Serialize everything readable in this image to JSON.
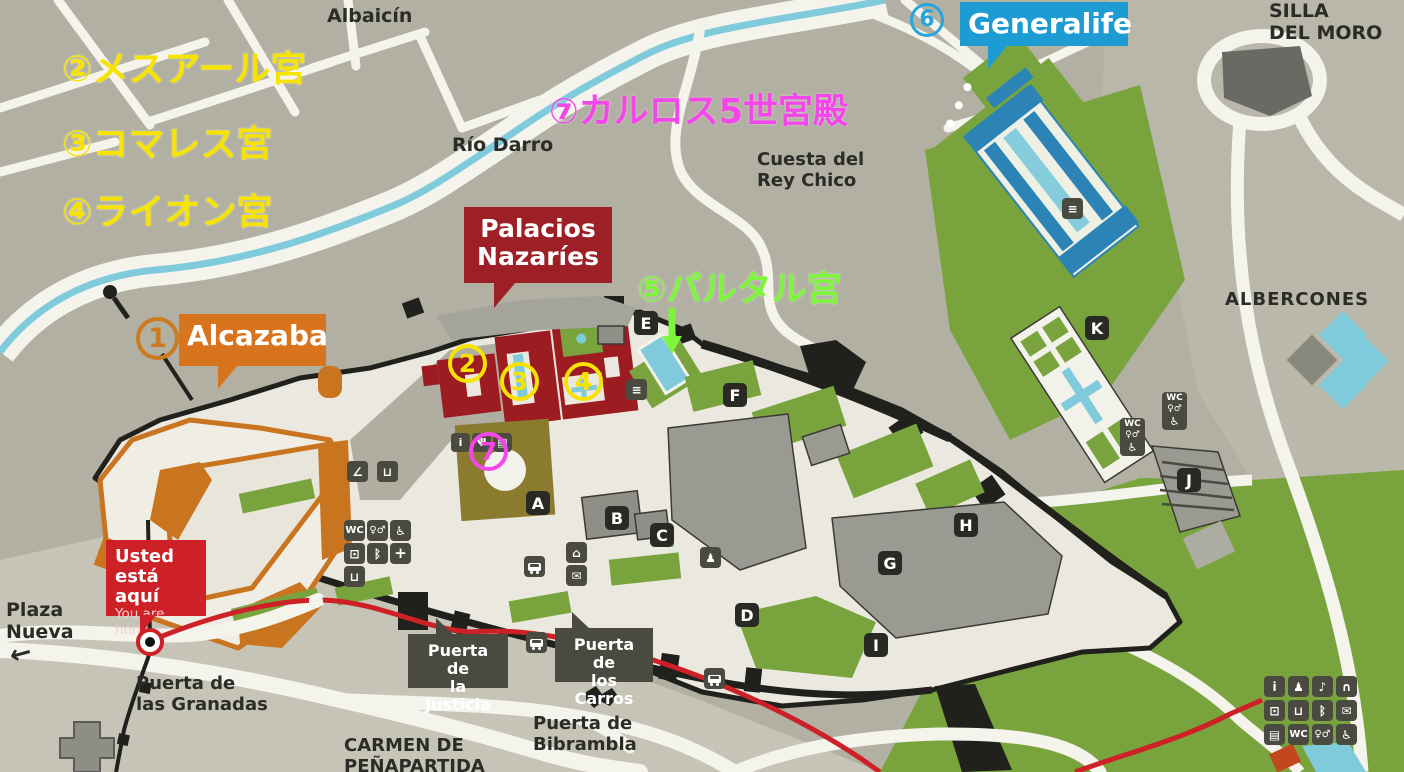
{
  "legend": {
    "mexuar": "②メスアール宮",
    "comares": "③コマレス宮",
    "lions": "④ライオン宮",
    "carlos": "⑦カルロス5世宮殿",
    "partal": "⑤パルタル宮"
  },
  "map_numbers": {
    "n1": "1",
    "n2": "2",
    "n3": "3",
    "n4": "4",
    "n6": "6",
    "n7": "7"
  },
  "badges": {
    "generalife": "Generalife",
    "alcazaba": "Alcazaba",
    "palacios_line1": "Palacios",
    "palacios_line2": "Nazaríes",
    "usted_line1": "Usted",
    "usted_line2": "está aquí",
    "usted_line3": "You are here",
    "justicia_line1": "Puerta de",
    "justicia_line2": "la Justicia",
    "carros_line1": "Puerta de",
    "carros_line2": "los Carros"
  },
  "labels": {
    "albaicin": "Albaicín",
    "rio_darro": "Río Darro",
    "cuesta_line1": "Cuesta del",
    "cuesta_line2": "Rey Chico",
    "silla_line1": "SILLA",
    "silla_line2": "DEL MORO",
    "albercones": "ALBERCONES",
    "plaza_line1": "Plaza",
    "plaza_line2": "Nueva",
    "plaza_arrow": "←",
    "granadas_line1": "Puerta de",
    "granadas_line2": "las Granadas",
    "bibrambla_line1": "Puerta de",
    "bibrambla_line2": "Bibrambla",
    "carmen_line1": "CARMEN DE",
    "carmen_line2": "PEÑAPARTIDA"
  },
  "map_letters": [
    "A",
    "B",
    "C",
    "D",
    "E",
    "F",
    "G",
    "H",
    "I",
    "J",
    "K"
  ],
  "icons": {
    "info": "i",
    "wc": "WC",
    "toilets": "♀♂",
    "wheelchair": "♿",
    "mail": "✉",
    "bluetooth": "ᛒ",
    "locker": "⊡",
    "drink": "⊔",
    "headphones": "∩",
    "audioguide": "♪",
    "shop": "▤",
    "firstaid": "+",
    "monument": "⌂",
    "stairs": "≡",
    "bench": "∠",
    "restaurant": "Ψ",
    "person": "♟"
  },
  "colors": {
    "annotation_yellow": "#f6e400",
    "annotation_magenta": "#f446ea",
    "annotation_green": "#7df53b",
    "annotation_blue": "#27a5da",
    "annotation_orange": "#cc7a1e",
    "badge_generalife": "#1d9cd3",
    "badge_alcazaba": "#d9741e",
    "badge_palacios": "#9c2025",
    "badge_usted": "#ce2027",
    "route_red": "#cd2127"
  }
}
